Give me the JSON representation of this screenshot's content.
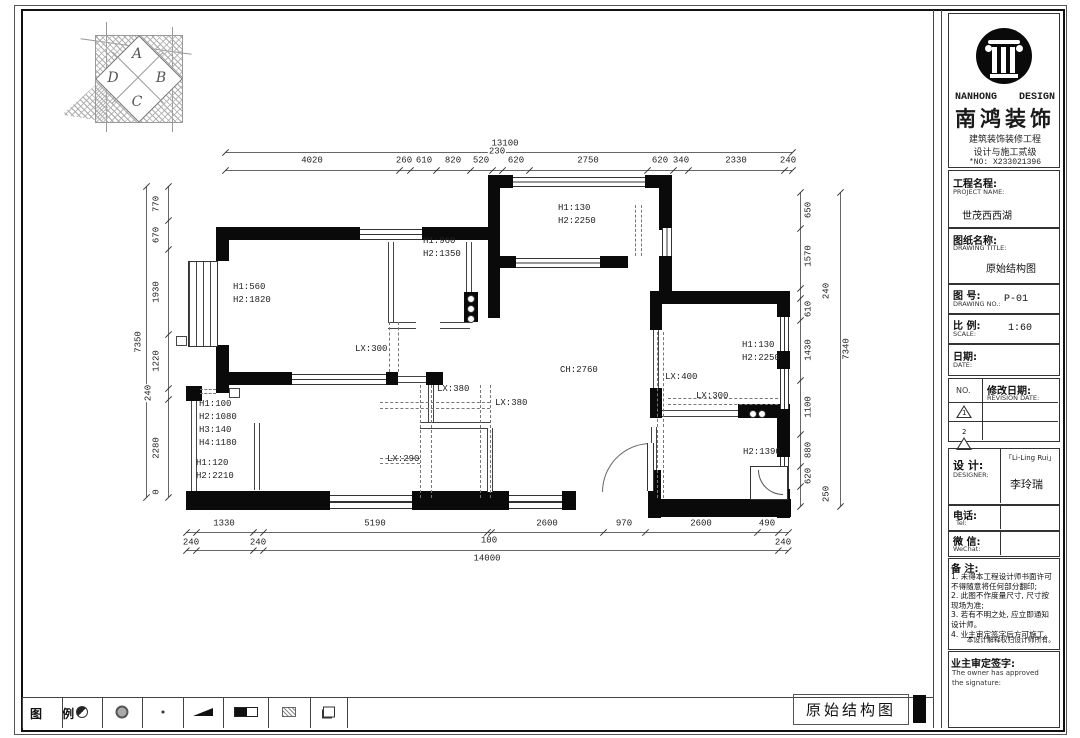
{
  "footer": {
    "drawing_label": "原始结构图"
  },
  "compass": {
    "letters": [
      "A",
      "B",
      "C",
      "D"
    ]
  },
  "legend": {
    "title": "图 例",
    "symbols": [
      "circle-half",
      "circle-ring",
      "dot",
      "wedge",
      "rect-half",
      "box-hatch",
      "square-shadow"
    ]
  },
  "title_block": {
    "brand": {
      "en_left": "NANHONG",
      "en_right": "DESIGN",
      "cn": "南鸿装饰",
      "sub1": "建筑装饰装修工程",
      "sub2": "设计与施工贰级",
      "no": "*NO: X233021396"
    },
    "project": {
      "label_cn": "工程名程:",
      "label_en": "PROJECT NAME:",
      "value": "世茂西西湖"
    },
    "drawing": {
      "label_cn": "图纸名称:",
      "label_en": "DRAWING TITLE:",
      "value": "原始结构图"
    },
    "number": {
      "label_cn": "图      号:",
      "label_en": "DRAWING NO.:",
      "value": "P-01"
    },
    "scale": {
      "label_cn": "比 例:",
      "label_en": "SCALE:",
      "value": "1:60"
    },
    "date": {
      "label_cn": "日期:",
      "label_en": "DATE:"
    },
    "revision": {
      "no_label": "NO.",
      "label_cn": "修改日期:",
      "label_en": "REVISION DATE:",
      "rows": [
        "1",
        "2"
      ]
    },
    "designer": {
      "label_cn": "设  计:",
      "label_en": "DESIGNER:",
      "value_en": "「Li-Ling Rui」",
      "value_cn": "李玲瑞"
    },
    "tel": {
      "label_cn": "电话:",
      "label_en": "Tel:"
    },
    "wechat": {
      "label_cn": "微 信:",
      "label_en": "WeChat:"
    },
    "notes": {
      "label": "备 注:",
      "lines": [
        "1. 未得本工程设计师书面许可",
        "   不得随意将任何部分翻印;",
        "2. 此图不作度量尺寸, 尺寸按",
        "   现场为准;",
        "3. 若有不明之处, 应立即通知",
        "   设计师。",
        "4. 业主审定签字后方可施工。"
      ],
      "rights": "本设计解释权归设计师所有。"
    },
    "approval": {
      "label_cn": "业主审定签字:",
      "line1": "The owner has approved",
      "line2": "the signature:"
    }
  },
  "plan": {
    "labels": [
      {
        "t": "H1:560",
        "x": 233,
        "y": 283
      },
      {
        "t": "H2:1820",
        "x": 233,
        "y": 296
      },
      {
        "t": "H1:960",
        "x": 423,
        "y": 237
      },
      {
        "t": "H2:1350",
        "x": 423,
        "y": 250
      },
      {
        "t": "H1:130",
        "x": 558,
        "y": 204
      },
      {
        "t": "H2:2250",
        "x": 558,
        "y": 217
      },
      {
        "t": "CH:2760",
        "x": 560,
        "y": 366
      },
      {
        "t": "H1:130",
        "x": 742,
        "y": 341
      },
      {
        "t": "H2:2250",
        "x": 742,
        "y": 354
      },
      {
        "t": "LX:400",
        "x": 665,
        "y": 373
      },
      {
        "t": "LX:300",
        "x": 696,
        "y": 392
      },
      {
        "t": "H2:1390",
        "x": 743,
        "y": 448
      },
      {
        "t": "LX:300",
        "x": 355,
        "y": 345
      },
      {
        "t": "LX:380",
        "x": 437,
        "y": 385
      },
      {
        "t": "LX:380",
        "x": 495,
        "y": 399
      },
      {
        "t": "LX:290",
        "x": 387,
        "y": 455
      },
      {
        "t": "H1:100",
        "x": 199,
        "y": 400
      },
      {
        "t": "H2:1080",
        "x": 199,
        "y": 413
      },
      {
        "t": "H3:140",
        "x": 199,
        "y": 426
      },
      {
        "t": "H4:1180",
        "x": 199,
        "y": 439
      },
      {
        "t": "H1:120",
        "x": 196,
        "y": 459
      },
      {
        "t": "H2:2210",
        "x": 196,
        "y": 472
      }
    ],
    "chains": [
      {
        "dir": "h",
        "x1": 225,
        "x2": 792,
        "y": 152,
        "ticks": [
          225,
          792
        ],
        "labels": [
          {
            "t": "13100",
            "x": 505,
            "y": 144
          }
        ]
      },
      {
        "dir": "h",
        "x1": 225,
        "x2": 792,
        "y": 170,
        "ticks": [
          225,
          399,
          410,
          436,
          470,
          492,
          502,
          529,
          647,
          673,
          688,
          784,
          792
        ],
        "labels": [
          {
            "t": "4020",
            "x": 312,
            "y": 161
          },
          {
            "t": "260",
            "x": 404,
            "y": 161
          },
          {
            "t": "610",
            "x": 424,
            "y": 161
          },
          {
            "t": "820",
            "x": 453,
            "y": 161
          },
          {
            "t": "520",
            "x": 481,
            "y": 161
          },
          {
            "t": "230",
            "x": 497,
            "y": 152
          },
          {
            "t": "620",
            "x": 516,
            "y": 161
          },
          {
            "t": "2750",
            "x": 588,
            "y": 161
          },
          {
            "t": "620",
            "x": 660,
            "y": 161
          },
          {
            "t": "340",
            "x": 681,
            "y": 161
          },
          {
            "t": "2330",
            "x": 736,
            "y": 161
          },
          {
            "t": "240",
            "x": 788,
            "y": 161
          }
        ]
      },
      {
        "dir": "v",
        "x": 146,
        "y1": 186,
        "y2": 497,
        "ticks": [
          186,
          497
        ],
        "labels": [
          {
            "t": "7350",
            "x": 139,
            "y": 342,
            "rot": true
          }
        ]
      },
      {
        "dir": "v",
        "x": 168,
        "y1": 186,
        "y2": 497,
        "ticks": [
          186,
          220,
          249,
          334,
          388,
          399,
          497
        ],
        "labels": [
          {
            "t": "770",
            "x": 157,
            "y": 204,
            "rot": true
          },
          {
            "t": "670",
            "x": 157,
            "y": 235,
            "rot": true
          },
          {
            "t": "1930",
            "x": 157,
            "y": 292,
            "rot": true
          },
          {
            "t": "1220",
            "x": 157,
            "y": 361,
            "rot": true
          },
          {
            "t": "240",
            "x": 149,
            "y": 393,
            "rot": true
          },
          {
            "t": "2280",
            "x": 157,
            "y": 448,
            "rot": true
          },
          {
            "t": "0",
            "x": 157,
            "y": 492,
            "rot": true
          }
        ]
      },
      {
        "dir": "v",
        "x": 800,
        "y1": 192,
        "y2": 506,
        "ticks": [
          192,
          228,
          288,
          298,
          320,
          380,
          434,
          466,
          486,
          506
        ],
        "labels": [
          {
            "t": "650",
            "x": 809,
            "y": 210,
            "rot": true
          },
          {
            "t": "1570",
            "x": 809,
            "y": 256,
            "rot": true
          },
          {
            "t": "240",
            "x": 827,
            "y": 291,
            "rot": true
          },
          {
            "t": "610",
            "x": 809,
            "y": 309,
            "rot": true
          },
          {
            "t": "1430",
            "x": 809,
            "y": 350,
            "rot": true
          },
          {
            "t": "1100",
            "x": 809,
            "y": 407,
            "rot": true
          },
          {
            "t": "880",
            "x": 809,
            "y": 450,
            "rot": true
          },
          {
            "t": "620",
            "x": 809,
            "y": 476,
            "rot": true
          },
          {
            "t": "250",
            "x": 827,
            "y": 494,
            "rot": true
          }
        ]
      },
      {
        "dir": "v",
        "x": 840,
        "y1": 192,
        "y2": 506,
        "ticks": [
          192,
          506
        ],
        "labels": [
          {
            "t": "7340",
            "x": 847,
            "y": 349,
            "rot": true
          }
        ]
      },
      {
        "dir": "h",
        "x1": 186,
        "x2": 788,
        "y": 532,
        "ticks": [
          186,
          196,
          253,
          263,
          487,
          491,
          603,
          645,
          757,
          778,
          788
        ],
        "labels": [
          {
            "t": "1330",
            "x": 224,
            "y": 524
          },
          {
            "t": "5190",
            "x": 375,
            "y": 524
          },
          {
            "t": "100",
            "x": 489,
            "y": 541
          },
          {
            "t": "2600",
            "x": 547,
            "y": 524
          },
          {
            "t": "970",
            "x": 624,
            "y": 524
          },
          {
            "t": "2600",
            "x": 701,
            "y": 524
          },
          {
            "t": "490",
            "x": 767,
            "y": 524
          }
        ]
      },
      {
        "dir": "h",
        "x1": 186,
        "x2": 788,
        "y": 550,
        "ticks": [
          186,
          196,
          253,
          263,
          778,
          788
        ],
        "labels": [
          {
            "t": "240",
            "x": 191,
            "y": 543
          },
          {
            "t": "240",
            "x": 258,
            "y": 543
          },
          {
            "t": "240",
            "x": 783,
            "y": 543
          },
          {
            "t": "14000",
            "x": 487,
            "y": 559
          }
        ]
      }
    ]
  }
}
